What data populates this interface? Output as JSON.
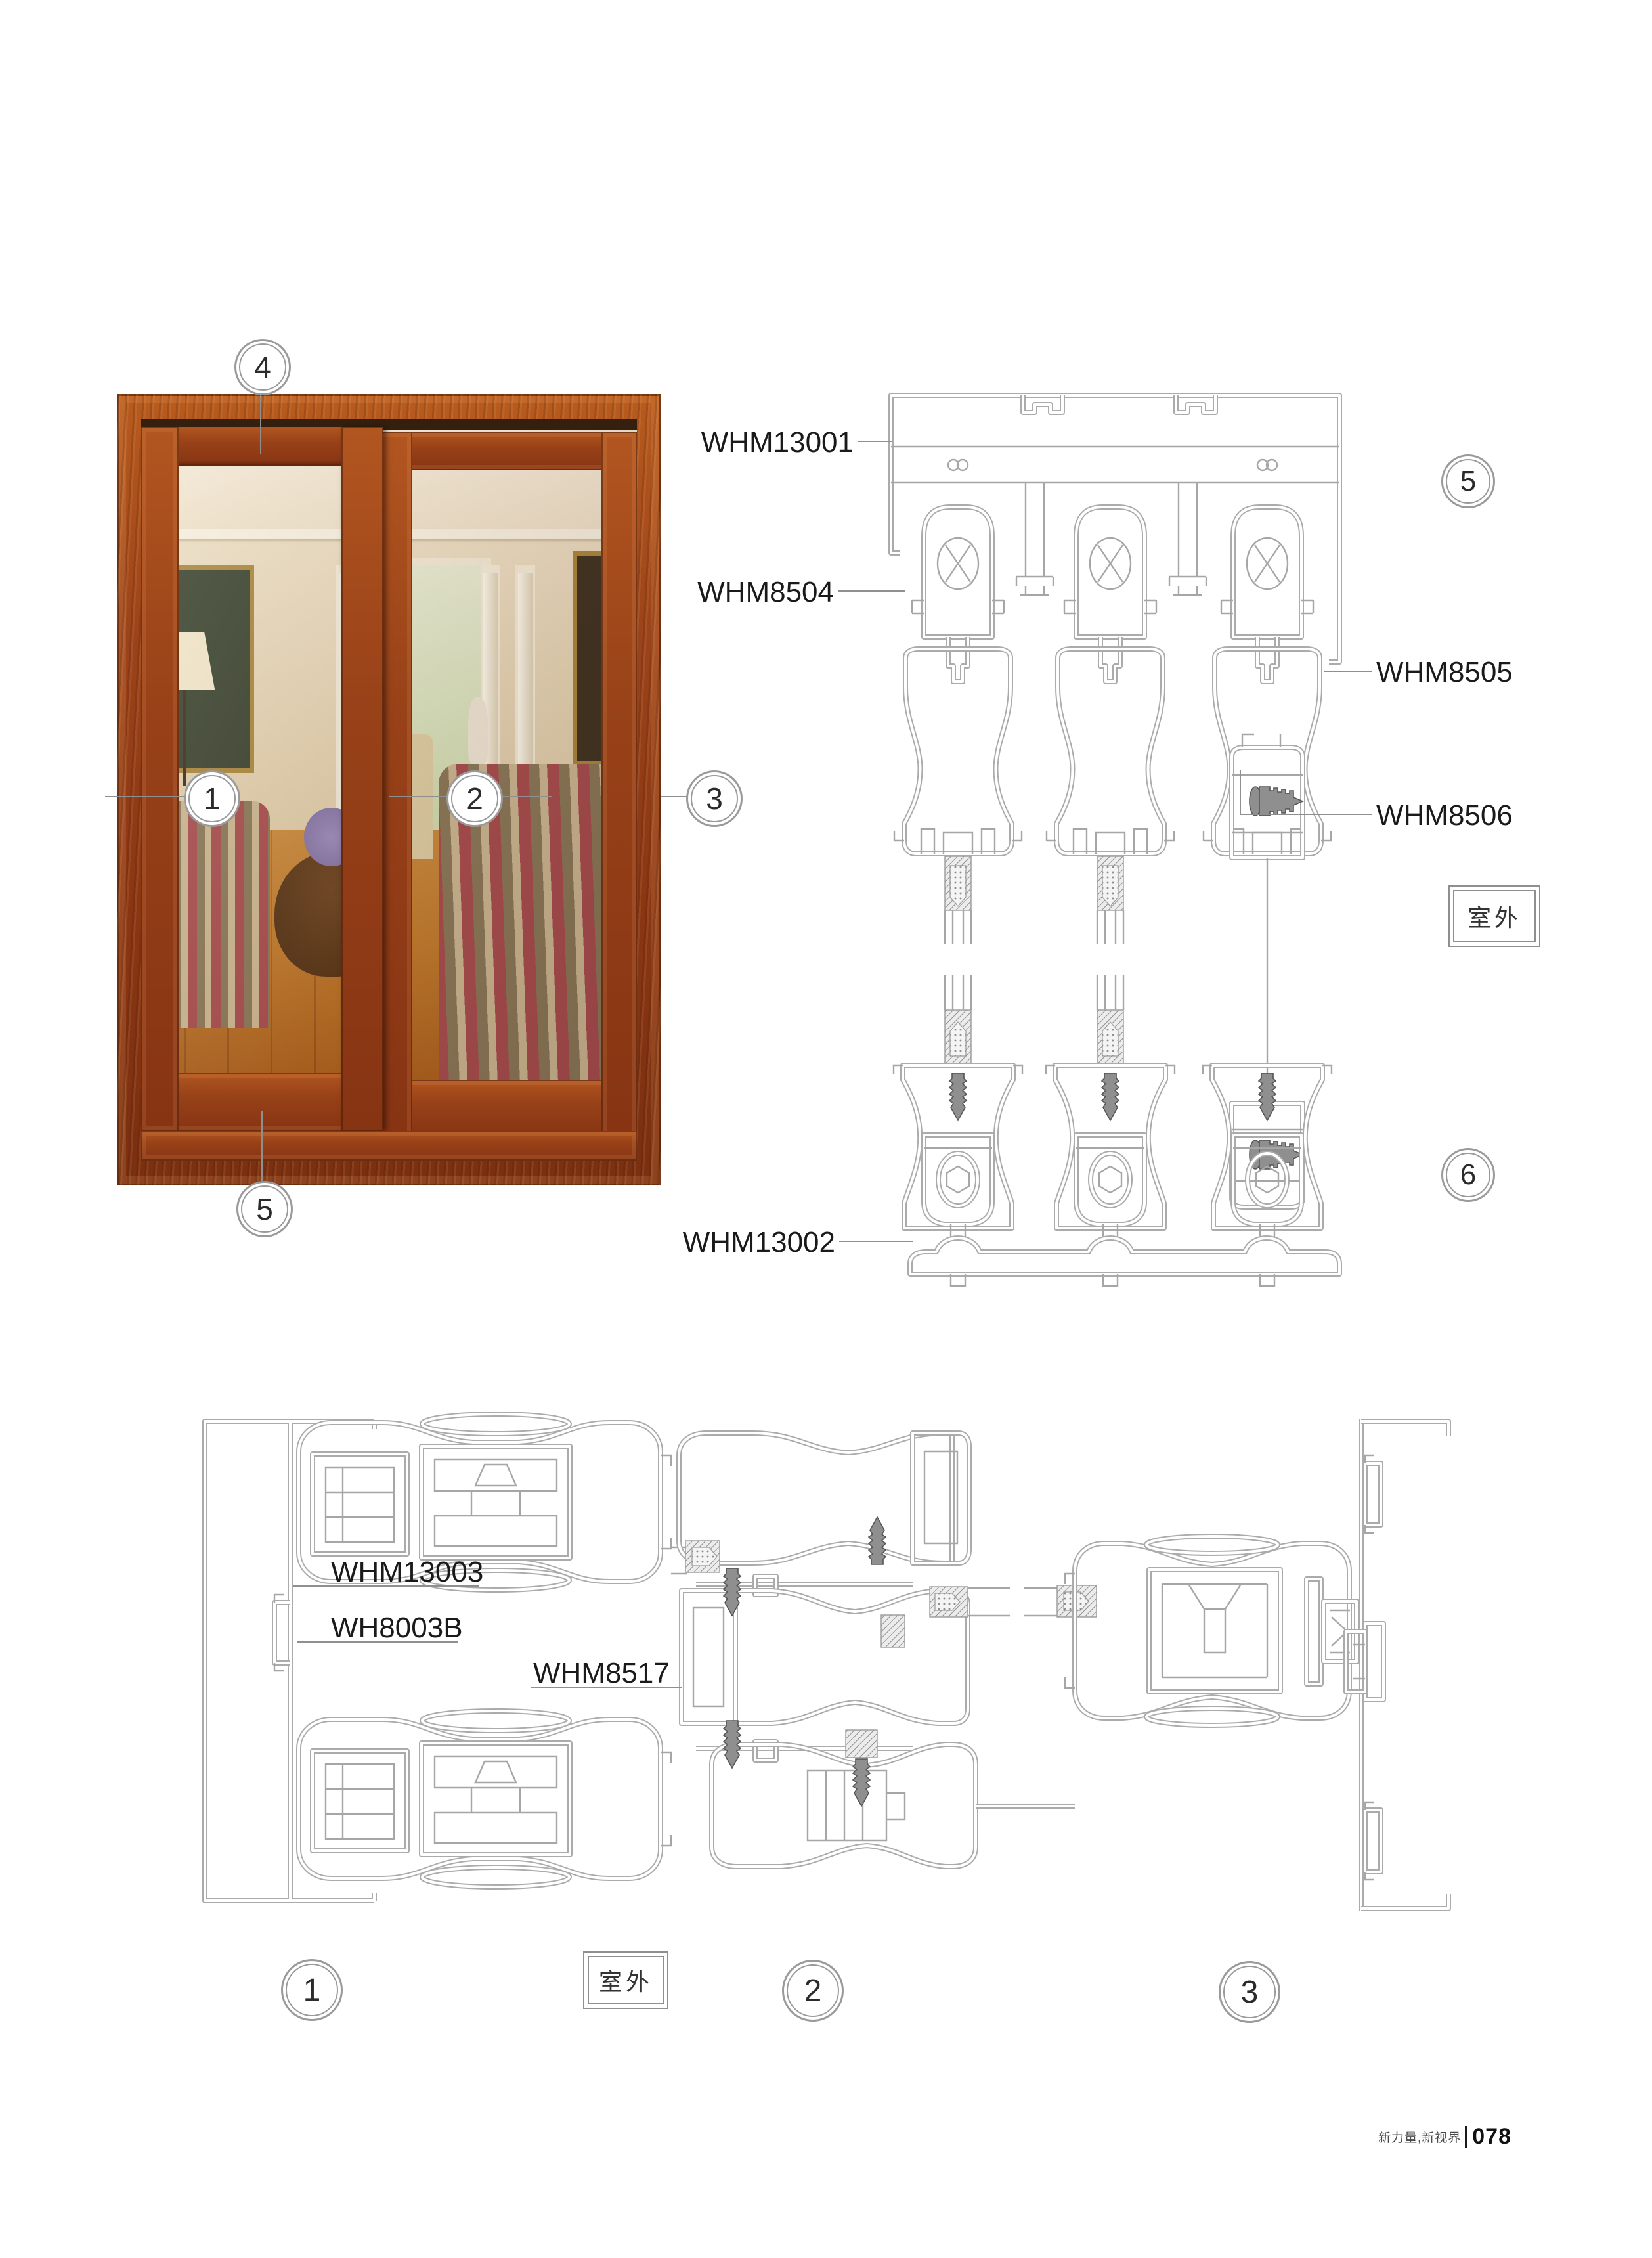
{
  "page": {
    "footer": {
      "slogan": "新力量,新视界",
      "page_number": "078"
    }
  },
  "photo": {
    "description": "wood-grain sliding door with two glass panels showing a living room interior",
    "callouts": {
      "top": "4",
      "left": "1",
      "middle": "2",
      "right": "3",
      "bottom": "5"
    }
  },
  "vertical_section": {
    "labels": {
      "top_track": "WHM13001",
      "sash_profile": "WHM8504",
      "sash_profile_right": "WHM8505",
      "interlock": "WHM8506",
      "bottom_track": "WHM13002"
    },
    "callouts": {
      "upper": "5",
      "lower": "6"
    },
    "outdoor_label": "室外"
  },
  "horizontal_section": {
    "labels": {
      "frame_profile": "WHM13003",
      "jamb_profile": "WH8003B",
      "meeting_stile": "WHM8517"
    },
    "callouts": {
      "left": "1",
      "middle": "2",
      "right": "3"
    },
    "outdoor_label": "室外"
  },
  "colors": {
    "page_bg": "#ffffff",
    "drawing_line": "#ababab",
    "leader_line": "#8f8f8f",
    "label_text": "#1a1a1a",
    "wood_frame": "#9c431a",
    "floor_wood": "#b96f28"
  }
}
